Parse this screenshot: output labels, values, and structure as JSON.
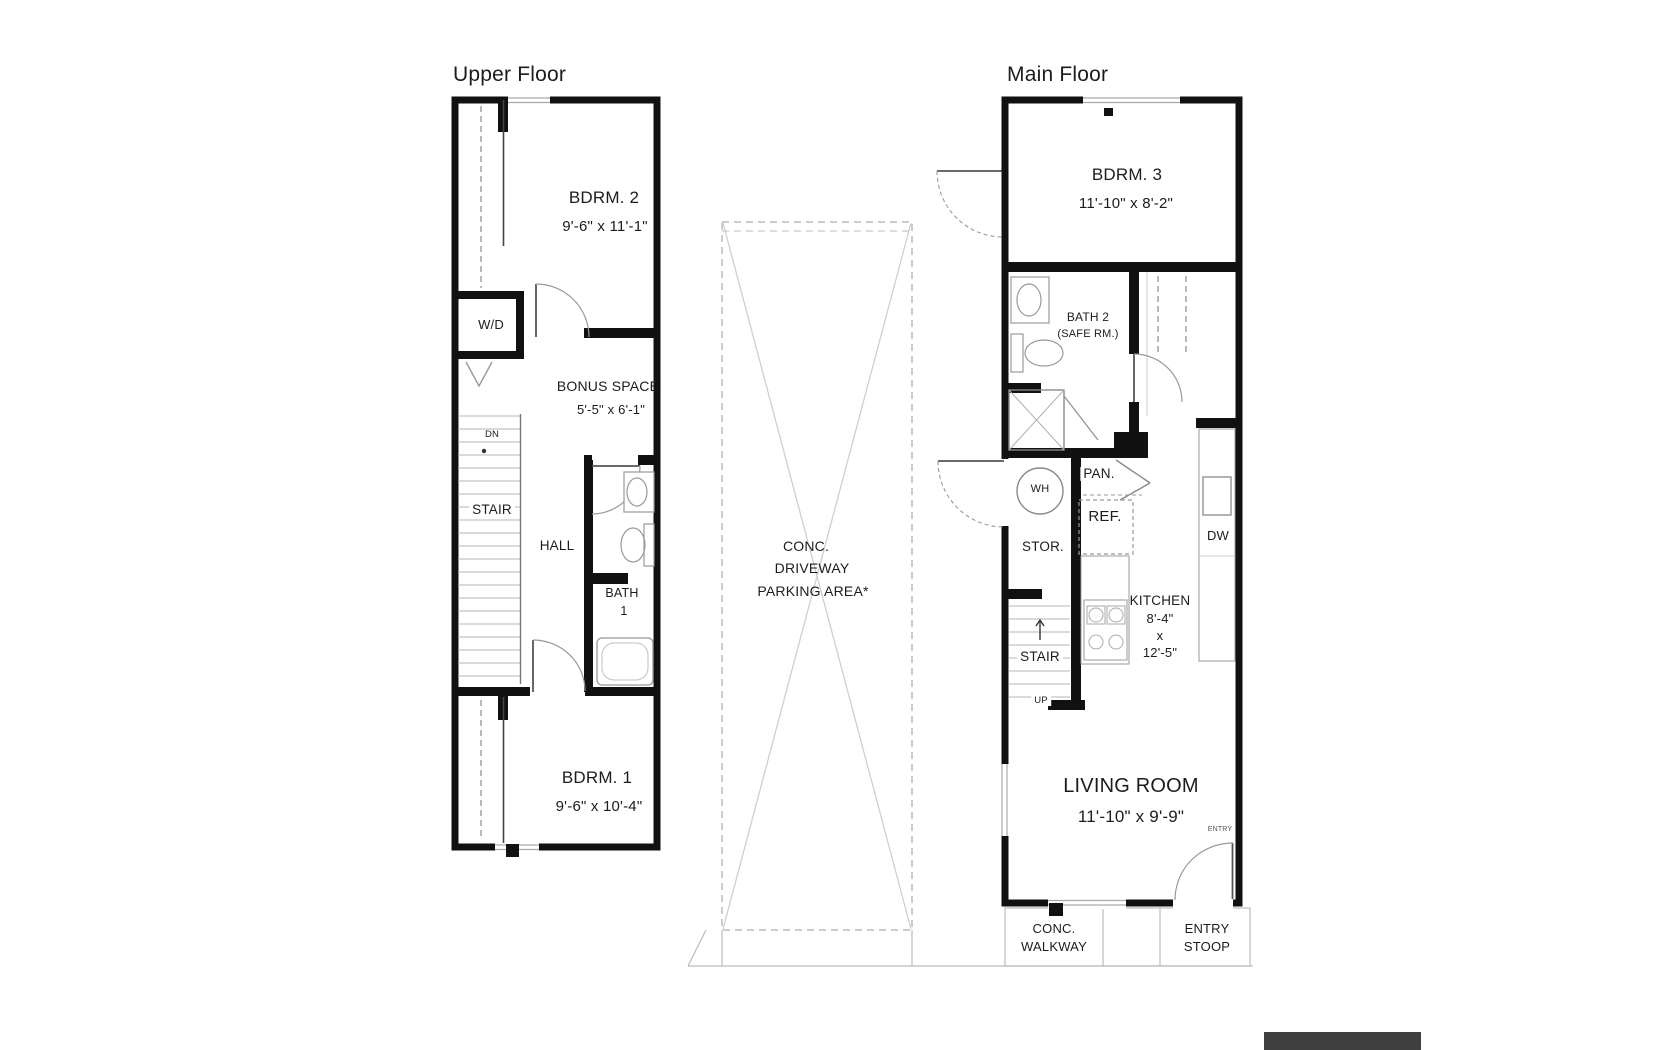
{
  "canvas": {
    "width": 1680,
    "height": 1050,
    "background": "#ffffff"
  },
  "colors": {
    "wall": "#111111",
    "thin_line": "#999999",
    "dash_line": "#bbbbbb",
    "text": "#1c1c1c",
    "watermark": "#3f3f3f"
  },
  "upper_floor": {
    "title": "Upper Floor",
    "bdrm2_name": "BDRM. 2",
    "bdrm2_dims": "9'-6\" x 11'-1\"",
    "wd_label": "W/D",
    "bonus_name": "BONUS SPACE",
    "bonus_dims": "5'-5\" x 6'-1\"",
    "stair_direction": "DN",
    "stair_label": "STAIR",
    "hall_label": "HALL",
    "bath_name": "BATH",
    "bath_number": "1",
    "bdrm1_name": "BDRM. 1",
    "bdrm1_dims": "9'-6\" x 10'-4\""
  },
  "driveway": {
    "label_line1": "CONC.",
    "label_line2": "DRIVEWAY",
    "label_line3": "PARKING AREA*"
  },
  "main_floor": {
    "title": "Main Floor",
    "bdrm3_name": "BDRM. 3",
    "bdrm3_dims": "11'-10\" x 8'-2\"",
    "bath2_name": "BATH 2",
    "bath2_note": "(SAFE RM.)",
    "wh_label": "WH",
    "pan_label": "PAN.",
    "ref_label": "REF.",
    "stor_label": "STOR.",
    "dw_label": "DW",
    "stair_label": "STAIR",
    "stair_direction": "UP",
    "kitchen_name": "KITCHEN",
    "kitchen_width": "8'-4\"",
    "kitchen_by": "x",
    "kitchen_length": "12'-5\"",
    "living_name": "LIVING ROOM",
    "living_dims": "11'-10\" x 9'-9\"",
    "entry_label": "ENTRY"
  },
  "site": {
    "walkway_line1": "CONC.",
    "walkway_line2": "WALKWAY",
    "stoop_line1": "ENTRY",
    "stoop_line2": "STOOP"
  }
}
